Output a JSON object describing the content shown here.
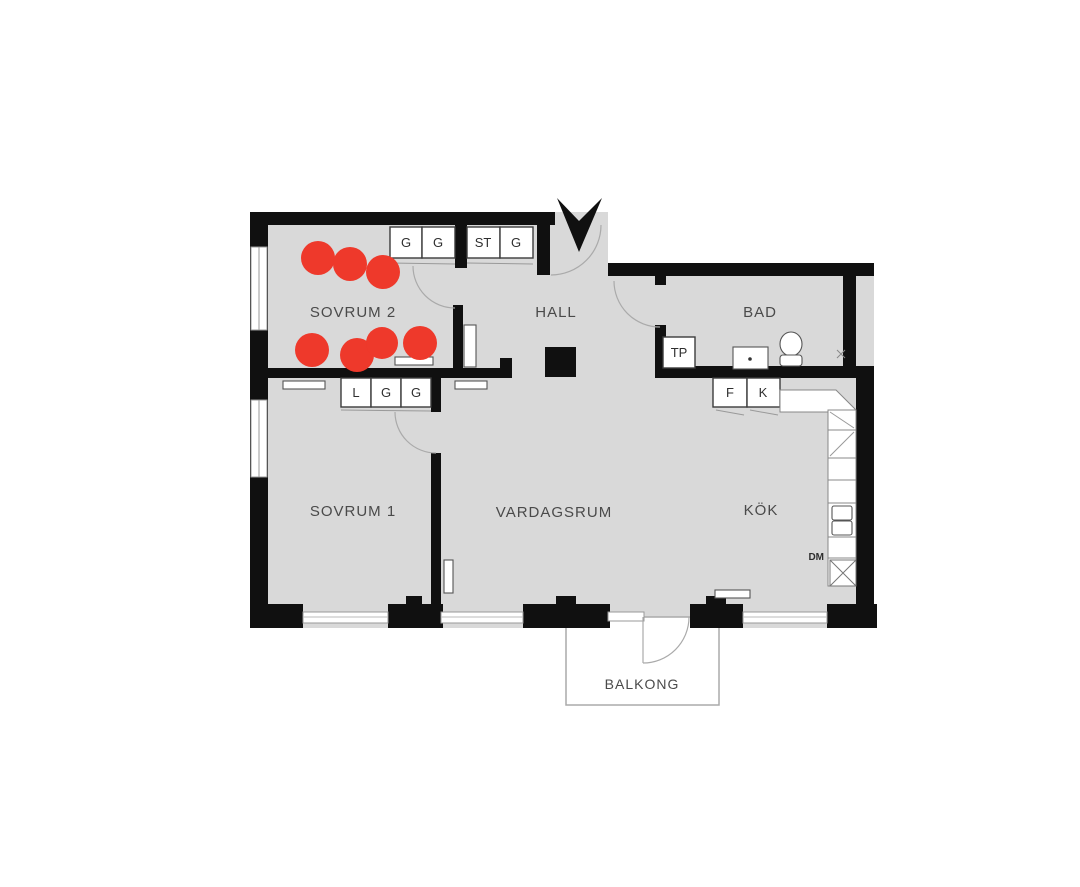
{
  "plan": {
    "rooms": {
      "sovrum2": "SOVRUM 2",
      "hall": "HALL",
      "bad": "BAD",
      "sovrum1": "SOVRUM 1",
      "vardagsrum": "VARDAGSRUM",
      "kok": "KÖK",
      "balkong": "BALKONG"
    },
    "closets": {
      "sovrum2_top": [
        "G",
        "G"
      ],
      "hall_top": [
        "ST",
        "G"
      ],
      "sovrum1_top": [
        "L",
        "G",
        "G"
      ]
    },
    "fixtures": {
      "bathroom_unit": "TP",
      "fridge": "F",
      "freezer": "K",
      "dishwasher": "DM"
    }
  },
  "markers": {
    "color": "#ee392b",
    "dots": [
      {
        "x": 318,
        "y": 258,
        "r": 17
      },
      {
        "x": 350,
        "y": 264,
        "r": 17
      },
      {
        "x": 383,
        "y": 272,
        "r": 17
      },
      {
        "x": 312,
        "y": 350,
        "r": 17
      },
      {
        "x": 357,
        "y": 355,
        "r": 17
      },
      {
        "x": 382,
        "y": 343,
        "r": 16
      },
      {
        "x": 420,
        "y": 343,
        "r": 17
      }
    ]
  },
  "colors": {
    "floor": "#d9d9d9",
    "wall": "#101010",
    "label": "#4a4a4a",
    "marker": "#ee392b"
  }
}
